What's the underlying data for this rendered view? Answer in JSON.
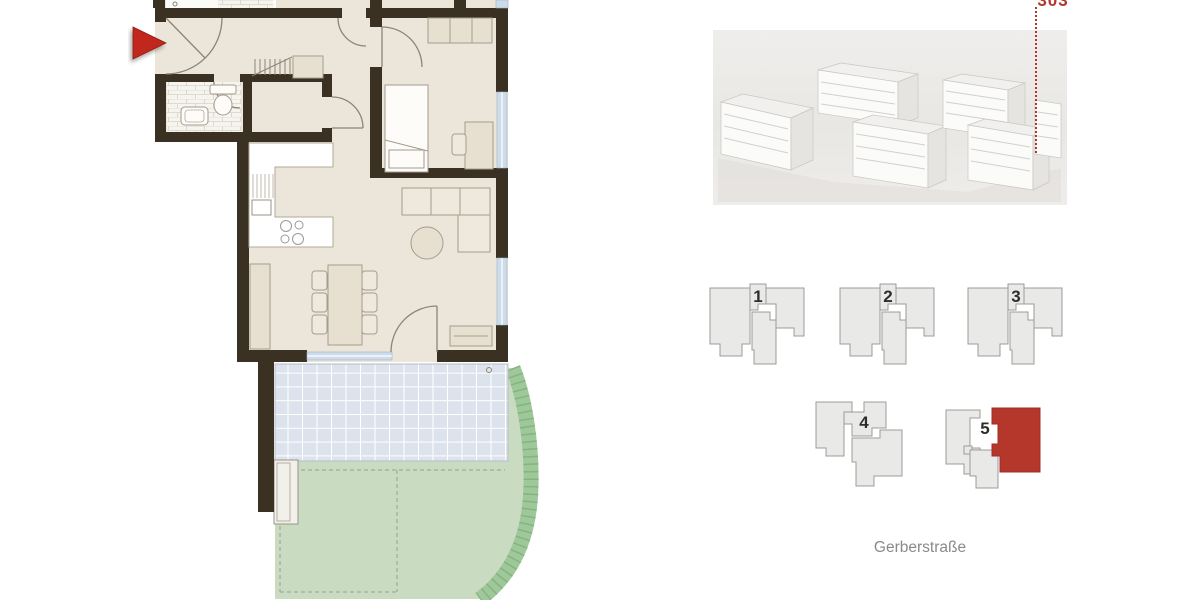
{
  "unit": {
    "number": "303"
  },
  "labels": {
    "street": "Gerberstraße"
  },
  "site_plan": {
    "buildings": [
      {
        "label": "1",
        "highlighted": false
      },
      {
        "label": "2",
        "highlighted": false
      },
      {
        "label": "3",
        "highlighted": false
      },
      {
        "label": "4",
        "highlighted": false
      },
      {
        "label": "5",
        "highlighted": true
      }
    ]
  },
  "icons": {
    "entrance_arrow": "entrance-direction-arrow",
    "leader_line": "dotted-leader-line"
  },
  "colors": {
    "accent_red": "#b5342c",
    "entrance_arrow_red": "#c1271c",
    "wall_dark": "#3a3123",
    "floor_beige": "#ece5da",
    "furniture_fill": "#e7dfd0",
    "terrace_tile_blue": "#dce3ec",
    "garden_green": "#c9dcc1",
    "hedge_green": "#94c08f",
    "footprint_gray": "#e9e9e8",
    "window_blue": "#ccdcea"
  }
}
